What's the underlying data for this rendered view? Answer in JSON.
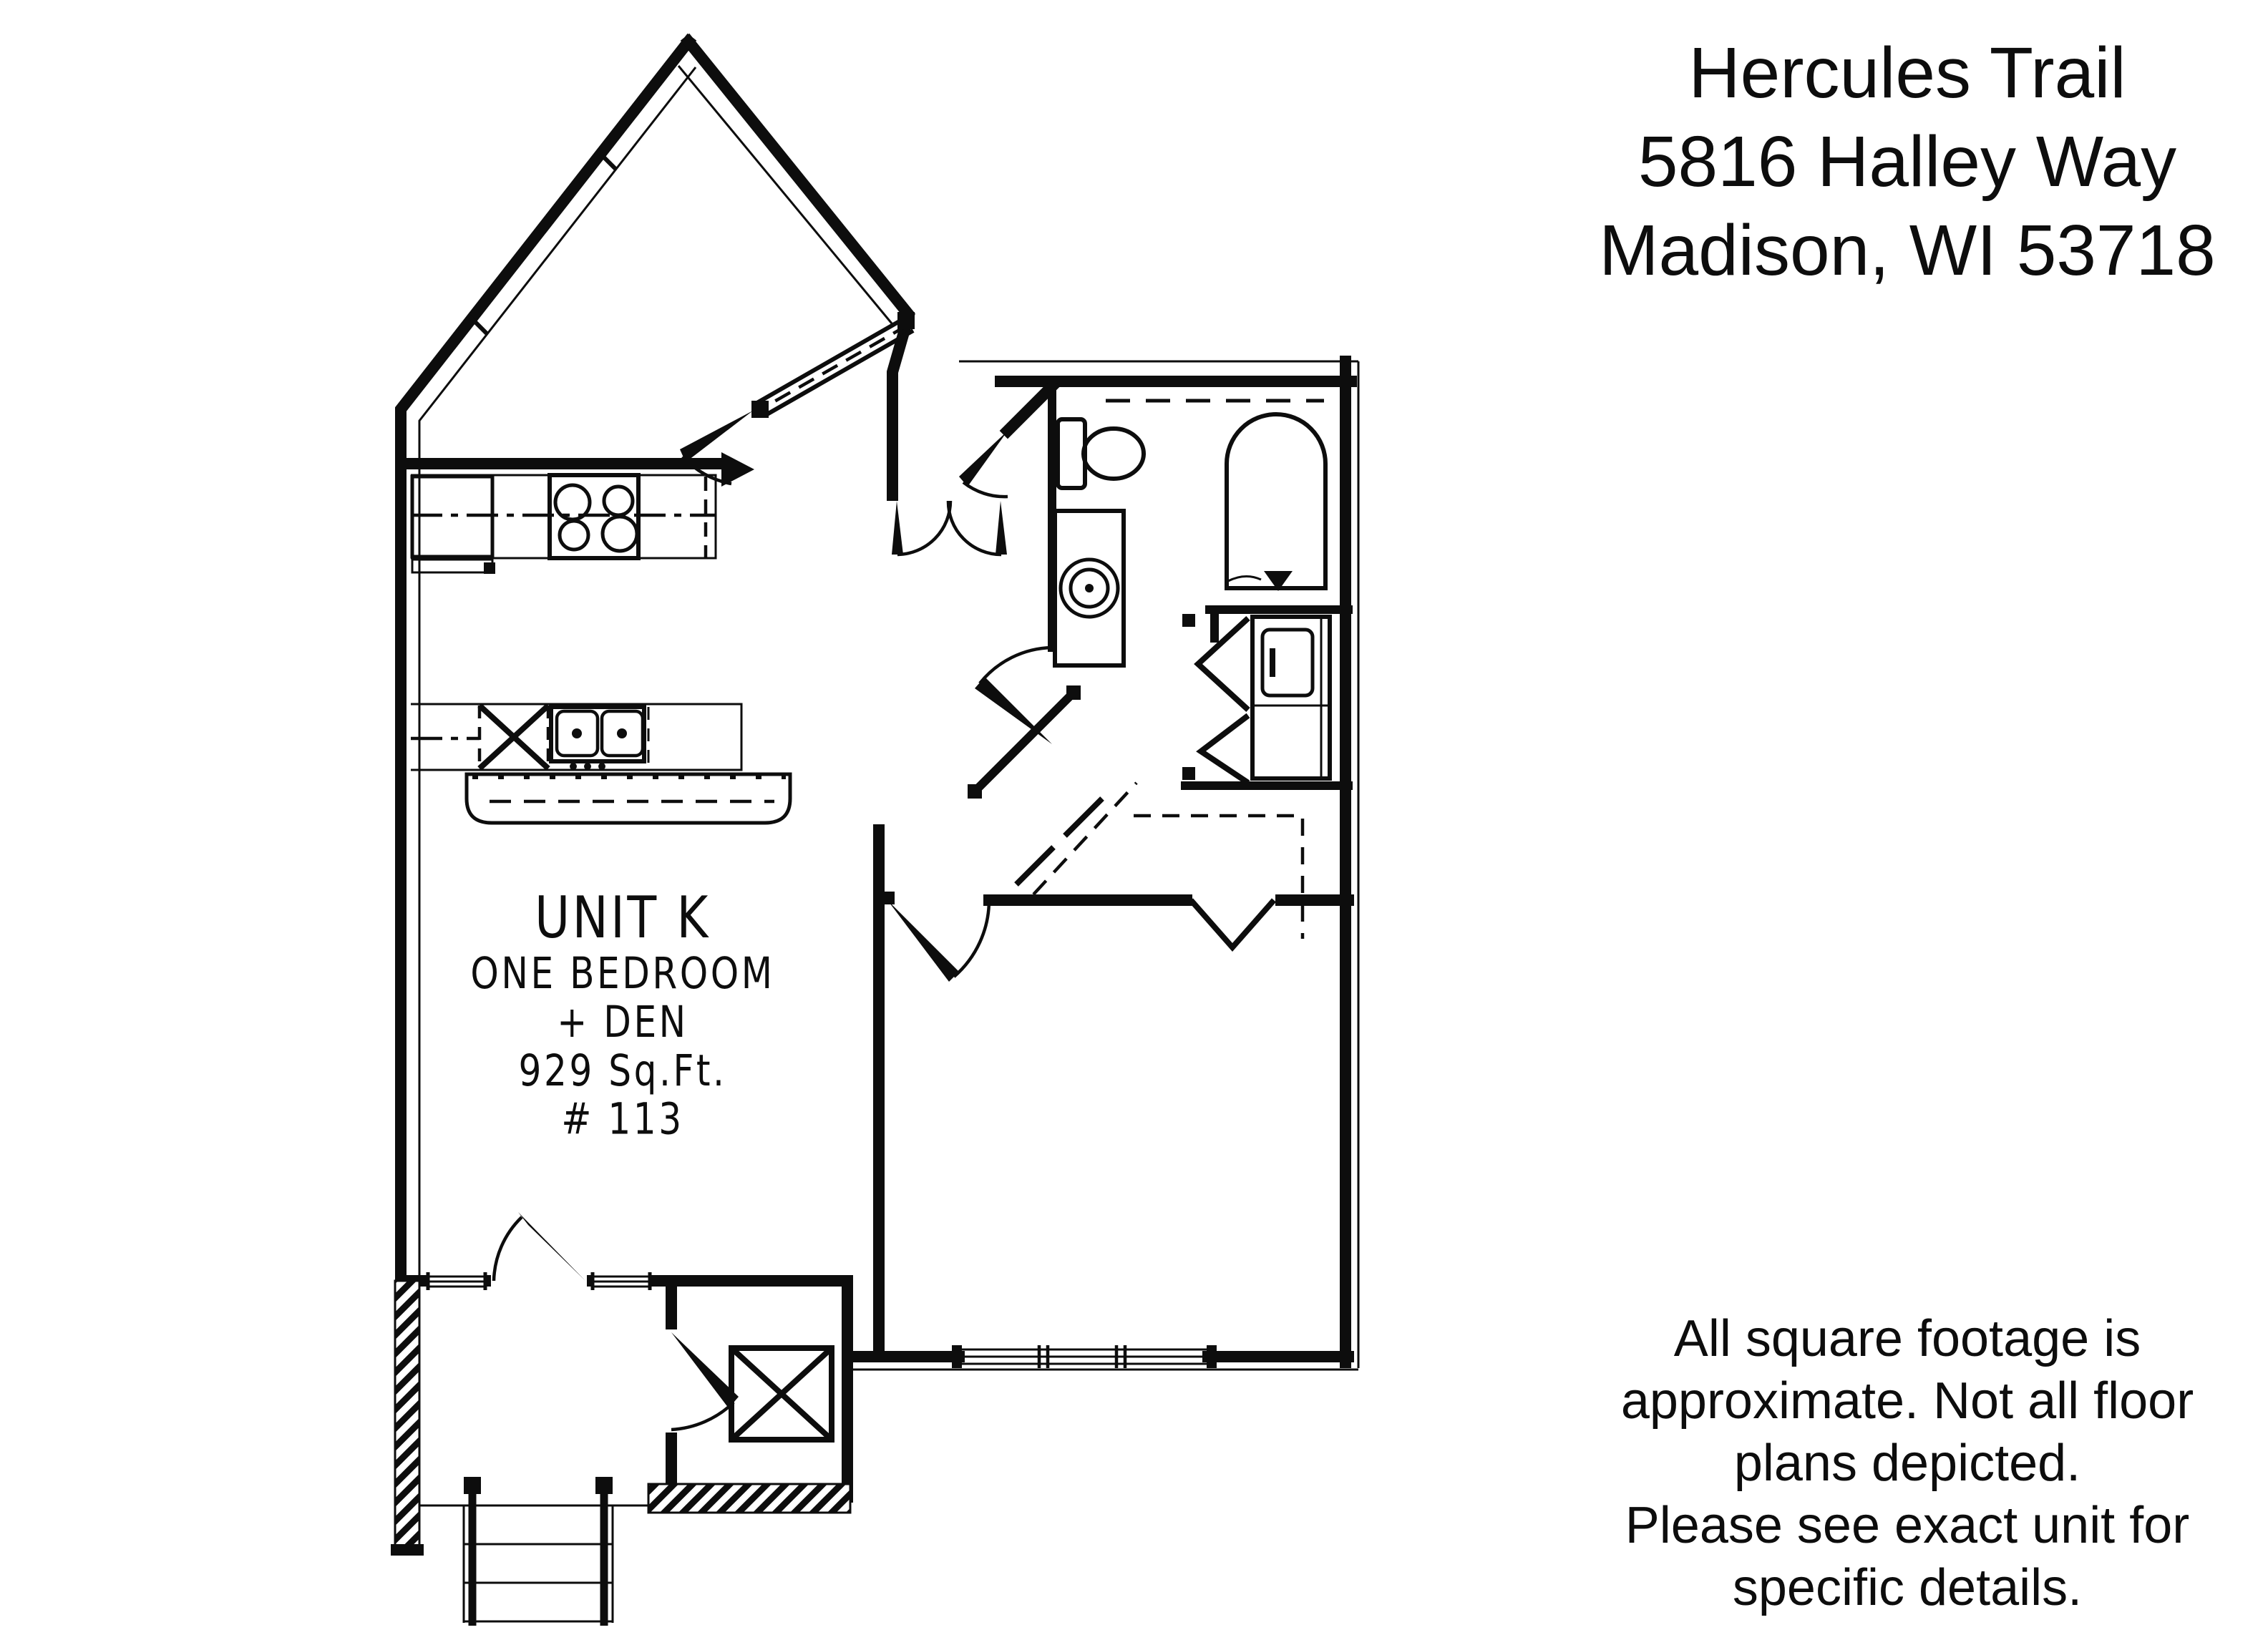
{
  "page": {
    "background": "#ffffff",
    "ink": "#0d0d0d",
    "kind": "apartment floor plan flyer"
  },
  "header": {
    "lines": [
      "Hercules Trail",
      "5816 Halley Way",
      "Madison, WI 53718"
    ]
  },
  "unit_label": {
    "lines": [
      "UNIT K",
      "ONE BEDROOM",
      "+ DEN",
      "929 Sq.Ft.",
      "# 113"
    ]
  },
  "disclaimer": {
    "lines": [
      "All square footage is",
      "approximate. Not all floor",
      "plans depicted.",
      "Please see exact unit for",
      "specific details."
    ]
  },
  "floor_plan": {
    "type": "architectural-line-drawing",
    "rooms_implied": [
      "living-dining",
      "kitchen",
      "entry",
      "bathroom",
      "laundry-closet",
      "linen-closet",
      "bedroom",
      "bedroom-closet",
      "porch",
      "storage-closet",
      "stairs"
    ],
    "fixtures": [
      "range-4-burner",
      "refrigerator",
      "dishwasher",
      "double-basin-sink",
      "breakfast-bar",
      "toilet",
      "vanity-sink",
      "bathtub",
      "washer-dryer-stack",
      "water-heater",
      "bifold-closet-doors",
      "door-swings",
      "windows",
      "stairs-with-railing"
    ]
  }
}
